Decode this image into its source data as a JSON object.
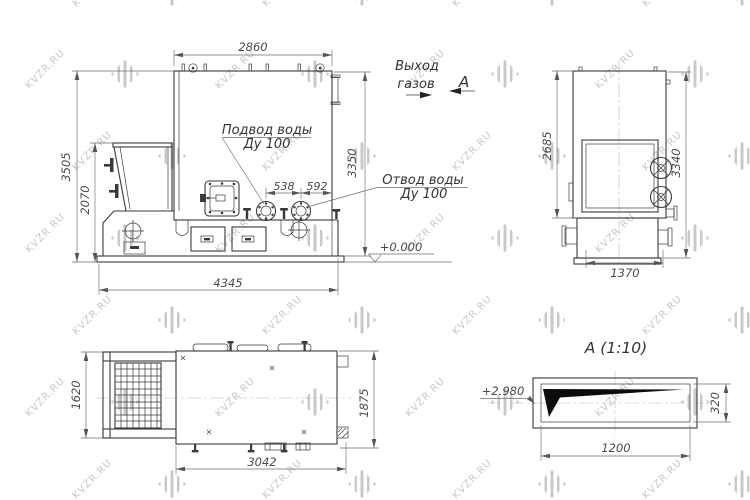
{
  "watermark": {
    "text": "KVZR.RU",
    "logo_icon": "diagonal-stripes-logo",
    "color": "#c9c9c9"
  },
  "front_view": {
    "dim_top_width": "2860",
    "dim_height_total": "3505",
    "dim_height_hopper": "2070",
    "dim_height_body": "3350",
    "dim_flange_span": "538",
    "dim_flange_to_edge": "592",
    "dim_length_total": "4345",
    "label_water_inlet_1": "Подвод воды",
    "label_water_inlet_2": "Ду 100",
    "label_water_outlet_1": "Отвод воды",
    "label_water_outlet_2": "Ду 100",
    "label_gas_outlet_1": "Выход",
    "label_gas_outlet_2": "газов",
    "label_view_marker": "А",
    "label_level": "+0.000"
  },
  "side_view": {
    "dim_door_height": "2685",
    "dim_height": "3340",
    "dim_width": "1370"
  },
  "plan_view": {
    "dim_grate_width": "1620",
    "dim_length": "3042",
    "dim_width": "1875"
  },
  "section_view": {
    "title": "А (1:10)",
    "label_level": "+2.980",
    "dim_width": "1200",
    "dim_height": "320"
  }
}
